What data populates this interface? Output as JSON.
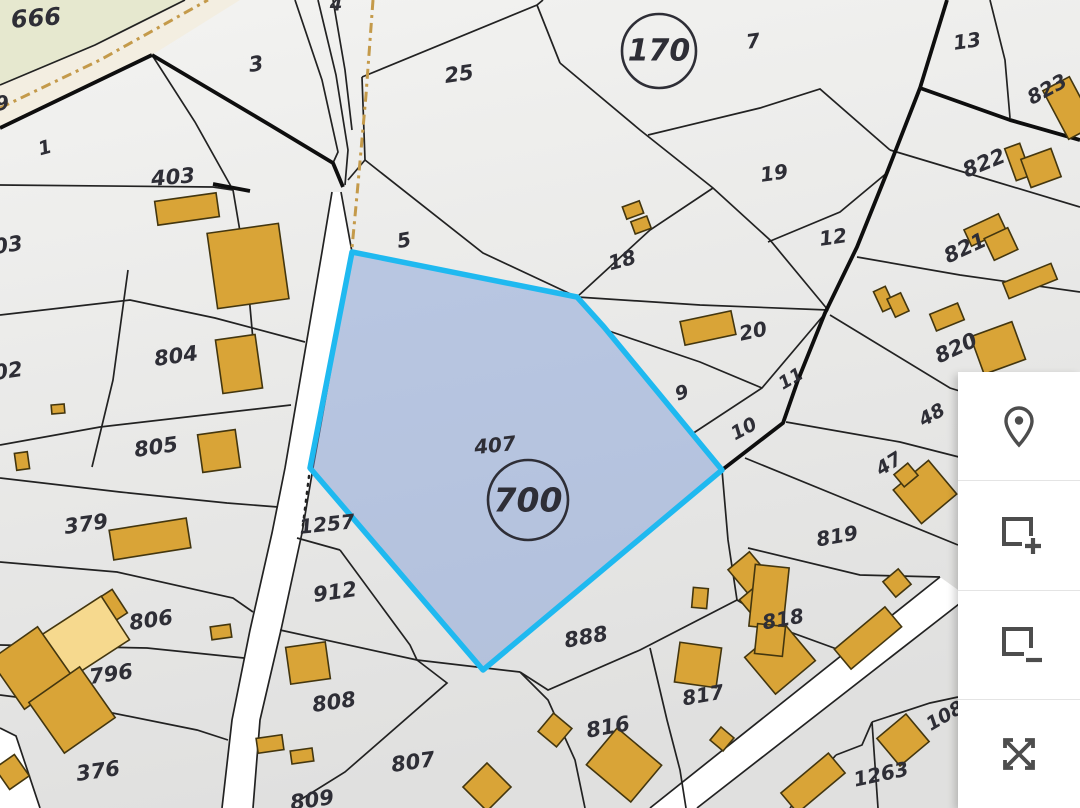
{
  "title": "Cadastral parcel map",
  "map": {
    "colors": {
      "bg_top": "#f3f3f1",
      "bg_bottom": "#e0e0df",
      "road": "#ffffff",
      "line_thin": "#222222",
      "line_thick": "#0e0e0e",
      "building": "#d9a437",
      "building_light": "#f6d98e",
      "building_outline": "#43360f",
      "selection_fill": "#7b9ad6",
      "selection_border": "#1fb9f0",
      "label": "#2e2e36",
      "tan_dash": "#c49a4a",
      "green_area": "#e6e8cf",
      "beige_road": "#f3eee1",
      "icon": "#4d4d4d"
    },
    "areas": [
      {
        "name": "grass-area",
        "points": "0,0 185,0 95,45 0,85",
        "fill": "#e6e8cf"
      },
      {
        "name": "dirt-road-area",
        "points": "0,85 95,45 185,0 240,0 152,55 0,128",
        "fill": "#f3eee1"
      }
    ],
    "roads": [
      {
        "name": "road-left",
        "points": "341,192 352,252 313,468 302,533 281,630 260,720 253,808 222,808 232,720 250,630 272,533 285,468 322,252 332,192"
      },
      {
        "name": "road-bottom-right",
        "points": "650,808 697,808 968,597 940,577"
      },
      {
        "name": "road-bottom-left",
        "points": "0,728 16,736 40,808 0,808"
      }
    ],
    "boundary_lines": {
      "thin": [
        "0,85 95,45 185,0",
        "152,55 195,122 233,190",
        "0,185 213,187 233,190",
        "233,190 247,273 253,340",
        "0,315 130,300 215,318 305,342",
        "0,445 100,427 230,412 291,405",
        "0,478 120,492 227,503 278,507",
        "0,562 117,572 233,598 253,612",
        "0,645 147,648 244,658",
        "0,695 63,703 197,730 228,740",
        "128,270 113,380 92,467",
        "295,0 322,80 338,152 333,163",
        "318,0 336,75 348,150 345,185",
        "333,0 345,70 352,130",
        "362,77 537,5 543,0",
        "537,5 560,63",
        "362,77 365,160",
        "365,160 483,253 577,297",
        "348,180 365,160",
        "560,63 640,130 713,188 770,240 828,310",
        "577,297 650,230 713,188",
        "577,297 700,305 828,310",
        "606,330 700,362 762,388",
        "648,135 760,108 820,89 890,150",
        "768,242 840,212 888,172",
        "828,310 762,388 692,434",
        "990,0 1005,60 1010,118",
        "890,150 990,180 1080,207",
        "857,257 960,275 1080,292",
        "830,315 950,388 1080,428",
        "786,422 900,442 1010,470",
        "745,458 860,505 958,545",
        "748,548 860,575 940,577",
        "722,470 728,540 737,600",
        "737,600 790,632 845,652",
        "520,672 548,690 640,650 737,600",
        "650,648 667,720 680,770 686,808",
        "280,630 417,660 520,672",
        "340,550 410,645 417,660",
        "297,538 340,550",
        "417,660 447,683 345,772 300,800",
        "520,672 548,700 575,760 585,808",
        "836,755 862,745 872,722",
        "872,722 930,703 958,697",
        "872,722 878,808",
        "790,808 836,755",
        "341,192 352,252 313,468 302,533 281,630 260,720 253,808",
        "332,192 322,252 285,468 272,533 250,630 232,720 222,808",
        "650,808 940,577",
        "697,808 968,597",
        "0,728 16,736 40,808"
      ],
      "thick": [
        "0,128 152,55",
        "152,55 270,125 333,163 343,187",
        "947,0 920,88",
        "920,88 1010,120 1080,140",
        "920,88 888,170 857,247 825,313 798,380 783,423 722,470",
        "213,184 250,191"
      ],
      "dotted": [
        "310,468 302,533"
      ],
      "tan_dashdot": [
        "373,0 366,95 357,195 352,248",
        "0,108 100,60 208,0"
      ]
    },
    "selected_parcel": {
      "points": "352,252 577,297 604,327 722,470 483,670 310,468",
      "number_label": "407",
      "number_x": 495,
      "number_y": 445,
      "area_circle_label": "700",
      "circle_x": 528,
      "circle_y": 500,
      "circle_r": 40
    },
    "block_circles": [
      {
        "label": "170",
        "x": 659,
        "y": 51,
        "r": 37
      }
    ],
    "labels": [
      {
        "text": "666",
        "x": 36,
        "y": 18,
        "s": 24,
        "r": -4
      },
      {
        "text": "4",
        "x": 336,
        "y": 5,
        "s": 18,
        "r": 0
      },
      {
        "text": "9",
        "x": 2,
        "y": 103,
        "s": 20,
        "r": -8
      },
      {
        "text": "3",
        "x": 256,
        "y": 64,
        "s": 21,
        "r": -8
      },
      {
        "text": "25",
        "x": 459,
        "y": 74,
        "s": 21,
        "r": -8
      },
      {
        "text": "7",
        "x": 753,
        "y": 41,
        "s": 20,
        "r": -8
      },
      {
        "text": "13",
        "x": 967,
        "y": 41,
        "s": 20,
        "r": -8
      },
      {
        "text": "823",
        "x": 1047,
        "y": 89,
        "s": 20,
        "r": -28
      },
      {
        "text": "1",
        "x": 45,
        "y": 148,
        "s": 19,
        "r": -15
      },
      {
        "text": "403",
        "x": 173,
        "y": 177,
        "s": 21,
        "r": -5
      },
      {
        "text": "822",
        "x": 984,
        "y": 163,
        "s": 21,
        "r": -22
      },
      {
        "text": "19",
        "x": 774,
        "y": 173,
        "s": 20,
        "r": -8
      },
      {
        "text": "12",
        "x": 833,
        "y": 237,
        "s": 20,
        "r": -8
      },
      {
        "text": "821",
        "x": 965,
        "y": 248,
        "s": 21,
        "r": -25
      },
      {
        "text": "03",
        "x": 8,
        "y": 245,
        "s": 21,
        "r": -8
      },
      {
        "text": "5",
        "x": 404,
        "y": 240,
        "s": 20,
        "r": -10
      },
      {
        "text": "18",
        "x": 622,
        "y": 260,
        "s": 20,
        "r": -15
      },
      {
        "text": "804",
        "x": 176,
        "y": 356,
        "s": 21,
        "r": -8
      },
      {
        "text": "20",
        "x": 753,
        "y": 331,
        "s": 20,
        "r": -12
      },
      {
        "text": "02",
        "x": 8,
        "y": 371,
        "s": 21,
        "r": -8
      },
      {
        "text": "820",
        "x": 956,
        "y": 348,
        "s": 21,
        "r": -25
      },
      {
        "text": "805",
        "x": 156,
        "y": 447,
        "s": 21,
        "r": -8
      },
      {
        "text": "9",
        "x": 682,
        "y": 393,
        "s": 19,
        "r": -18
      },
      {
        "text": "11",
        "x": 791,
        "y": 379,
        "s": 18,
        "r": -30
      },
      {
        "text": "10",
        "x": 744,
        "y": 429,
        "s": 19,
        "r": -28
      },
      {
        "text": "48",
        "x": 932,
        "y": 415,
        "s": 19,
        "r": -30
      },
      {
        "text": "47",
        "x": 889,
        "y": 464,
        "s": 19,
        "r": -32
      },
      {
        "text": "379",
        "x": 86,
        "y": 524,
        "s": 21,
        "r": -8
      },
      {
        "text": "1257",
        "x": 327,
        "y": 524,
        "s": 20,
        "r": -6
      },
      {
        "text": "819",
        "x": 837,
        "y": 536,
        "s": 20,
        "r": -10
      },
      {
        "text": "912",
        "x": 335,
        "y": 592,
        "s": 21,
        "r": -8
      },
      {
        "text": "806",
        "x": 151,
        "y": 620,
        "s": 21,
        "r": -8
      },
      {
        "text": "888",
        "x": 586,
        "y": 637,
        "s": 21,
        "r": -10
      },
      {
        "text": "818",
        "x": 783,
        "y": 619,
        "s": 20,
        "r": -10
      },
      {
        "text": "796",
        "x": 111,
        "y": 674,
        "s": 21,
        "r": -8
      },
      {
        "text": "817",
        "x": 703,
        "y": 695,
        "s": 20,
        "r": -10
      },
      {
        "text": "808",
        "x": 334,
        "y": 702,
        "s": 21,
        "r": -8
      },
      {
        "text": "816",
        "x": 608,
        "y": 727,
        "s": 21,
        "r": -10
      },
      {
        "text": "376",
        "x": 98,
        "y": 771,
        "s": 21,
        "r": -8
      },
      {
        "text": "807",
        "x": 413,
        "y": 762,
        "s": 21,
        "r": -8
      },
      {
        "text": "1263",
        "x": 881,
        "y": 774,
        "s": 20,
        "r": -12
      },
      {
        "text": "108",
        "x": 945,
        "y": 716,
        "s": 19,
        "r": -30
      },
      {
        "text": "809",
        "x": 312,
        "y": 800,
        "s": 21,
        "r": -8
      }
    ],
    "buildings": [
      {
        "x": 187,
        "y": 209,
        "w": 62,
        "h": 24,
        "r": -8
      },
      {
        "x": 248,
        "y": 266,
        "w": 72,
        "h": 76,
        "r": -8
      },
      {
        "x": 633,
        "y": 210,
        "w": 18,
        "h": 13,
        "r": -20
      },
      {
        "x": 641,
        "y": 225,
        "w": 17,
        "h": 13,
        "r": -20
      },
      {
        "x": 708,
        "y": 328,
        "w": 52,
        "h": 24,
        "r": -12
      },
      {
        "x": 884,
        "y": 299,
        "w": 13,
        "h": 22,
        "r": -25
      },
      {
        "x": 898,
        "y": 305,
        "w": 15,
        "h": 20,
        "r": -25
      },
      {
        "x": 1030,
        "y": 281,
        "w": 52,
        "h": 17,
        "r": -22
      },
      {
        "x": 1018,
        "y": 162,
        "w": 16,
        "h": 34,
        "r": -20
      },
      {
        "x": 1041,
        "y": 168,
        "w": 32,
        "h": 30,
        "r": -20
      },
      {
        "x": 1069,
        "y": 108,
        "w": 30,
        "h": 55,
        "r": -28
      },
      {
        "x": 985,
        "y": 230,
        "w": 38,
        "h": 18,
        "r": -25
      },
      {
        "x": 1001,
        "y": 244,
        "w": 26,
        "h": 24,
        "r": -25
      },
      {
        "x": 947,
        "y": 317,
        "w": 30,
        "h": 18,
        "r": -22
      },
      {
        "x": 998,
        "y": 348,
        "w": 44,
        "h": 40,
        "r": -20
      },
      {
        "x": 925,
        "y": 492,
        "w": 46,
        "h": 44,
        "r": -40
      },
      {
        "x": 906,
        "y": 475,
        "w": 18,
        "h": 16,
        "r": -40
      },
      {
        "x": 239,
        "y": 364,
        "w": 40,
        "h": 54,
        "r": -8
      },
      {
        "x": 219,
        "y": 451,
        "w": 38,
        "h": 38,
        "r": -8
      },
      {
        "x": 58,
        "y": 409,
        "w": 13,
        "h": 9,
        "r": -5
      },
      {
        "x": 22,
        "y": 461,
        "w": 13,
        "h": 17,
        "r": -8
      },
      {
        "x": 150,
        "y": 539,
        "w": 78,
        "h": 30,
        "r": -9
      },
      {
        "x": 103,
        "y": 612,
        "w": 40,
        "h": 28,
        "r": -33
      },
      {
        "x": 86,
        "y": 637,
        "w": 70,
        "h": 52,
        "r": -33,
        "light": true
      },
      {
        "x": 48,
        "y": 668,
        "w": 16,
        "h": 36,
        "r": -33
      },
      {
        "x": 221,
        "y": 632,
        "w": 20,
        "h": 13,
        "r": -8
      },
      {
        "x": 31,
        "y": 668,
        "w": 58,
        "h": 60,
        "r": -35
      },
      {
        "x": 72,
        "y": 710,
        "w": 62,
        "h": 62,
        "r": -35
      },
      {
        "x": 12,
        "y": 772,
        "w": 24,
        "h": 26,
        "r": -35
      },
      {
        "x": 308,
        "y": 663,
        "w": 40,
        "h": 37,
        "r": -8
      },
      {
        "x": 270,
        "y": 744,
        "w": 26,
        "h": 15,
        "r": -8
      },
      {
        "x": 302,
        "y": 756,
        "w": 22,
        "h": 13,
        "r": -8
      },
      {
        "x": 487,
        "y": 787,
        "w": 34,
        "h": 34,
        "r": 45
      },
      {
        "x": 555,
        "y": 730,
        "w": 24,
        "h": 24,
        "r": 40
      },
      {
        "x": 624,
        "y": 765,
        "w": 58,
        "h": 48,
        "r": 40
      },
      {
        "x": 698,
        "y": 665,
        "w": 42,
        "h": 40,
        "r": 8
      },
      {
        "x": 749,
        "y": 573,
        "w": 28,
        "h": 32,
        "r": -40
      },
      {
        "x": 757,
        "y": 602,
        "w": 24,
        "h": 26,
        "r": -40
      },
      {
        "x": 780,
        "y": 659,
        "w": 52,
        "h": 48,
        "r": -40
      },
      {
        "x": 897,
        "y": 583,
        "w": 20,
        "h": 20,
        "r": -40
      },
      {
        "x": 868,
        "y": 638,
        "w": 66,
        "h": 26,
        "r": -40
      },
      {
        "x": 722,
        "y": 739,
        "w": 17,
        "h": 17,
        "r": 40
      },
      {
        "x": 813,
        "y": 783,
        "w": 62,
        "h": 26,
        "r": -40
      },
      {
        "x": 903,
        "y": 740,
        "w": 38,
        "h": 36,
        "r": -40
      },
      {
        "x": 769,
        "y": 597,
        "w": 34,
        "h": 62,
        "r": 6
      },
      {
        "x": 770,
        "y": 640,
        "w": 28,
        "h": 30,
        "r": 6
      },
      {
        "x": 700,
        "y": 598,
        "w": 15,
        "h": 20,
        "r": 5
      }
    ]
  },
  "toolbar": {
    "buttons": [
      {
        "name": "locate-button",
        "icon": "map-pin-icon"
      },
      {
        "name": "add-selection-button",
        "icon": "rectangle-plus-icon"
      },
      {
        "name": "remove-selection-button",
        "icon": "rectangle-minus-icon"
      },
      {
        "name": "fullscreen-button",
        "icon": "expand-icon"
      }
    ]
  }
}
